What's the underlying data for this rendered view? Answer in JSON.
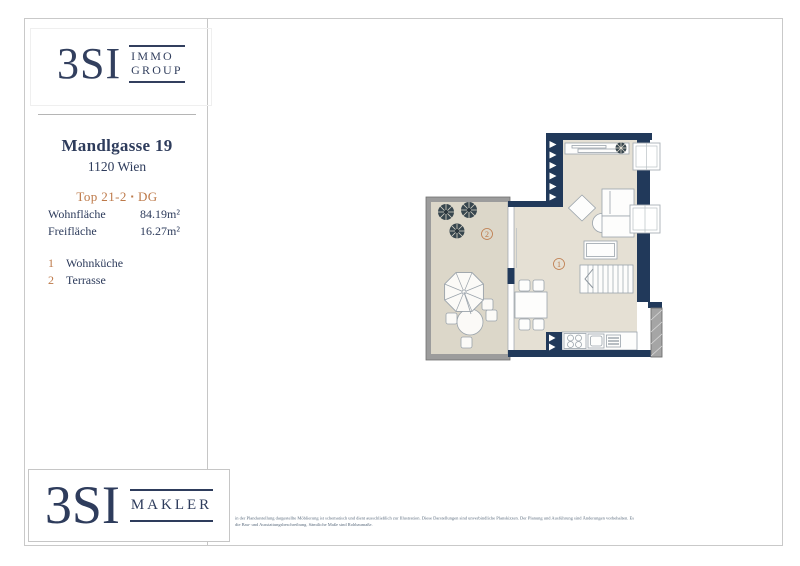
{
  "brand": {
    "top_logo": {
      "name": "3SI",
      "division_line1": "IMMO",
      "division_line2": "GROUP"
    },
    "bottom_logo": {
      "name": "3SI",
      "division": "MAKLER"
    }
  },
  "property": {
    "street": "Mandlgasse 19",
    "district": "1120 Wien",
    "unit": "Top 21-2",
    "separator": "▪",
    "floor": "DG"
  },
  "areas": [
    {
      "label": "Wohnfläche",
      "value": "84.19m²"
    },
    {
      "label": "Freifläche",
      "value": "16.27m²"
    }
  ],
  "legend": [
    {
      "num": "1",
      "label": "Wohnküche"
    },
    {
      "num": "2",
      "label": "Terrasse"
    }
  ],
  "plan": {
    "labels": [
      {
        "num": "1",
        "room": "Wohnküche"
      },
      {
        "num": "2",
        "room": "Terrasse"
      }
    ]
  },
  "disclaimer": {
    "line1": "in der Plandarstellung dargestellte Möblierung ist schematisch und dient ausschließlich zur Illustration. Diese Darstellungen sind unverbindliche Planskizzen. Der Planung und Ausführung sind Änderungen vorbehalten. Es",
    "line2": "die Bau- und Ausstattungsbeschreibung. Sämtliche Maße sind Rohbaumaße."
  },
  "colors": {
    "navy": "#2e3c5c",
    "wall": "#21395a",
    "accent": "#bd7949",
    "floor": "#e5e0d4",
    "terrace_floor": "#dcd7c9",
    "terrace_wall": "#9c9c9c"
  }
}
